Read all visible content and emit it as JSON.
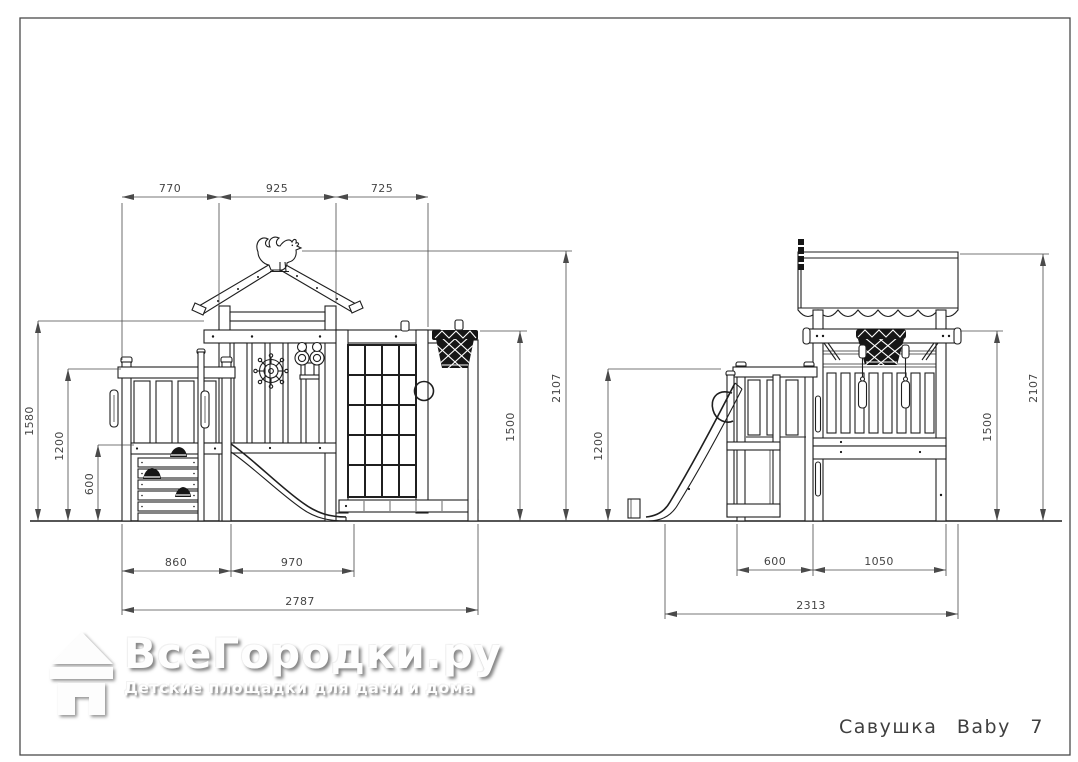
{
  "page": {
    "background": "#ffffff",
    "frame_color": "#4a4a4a",
    "line_color": "#1f1f1f"
  },
  "logo": {
    "brand": "ВсеГородки.ру",
    "tagline": "Детские площадки для дачи и дома",
    "icon": "house-icon"
  },
  "drawing_title": "Савушка Baby 7",
  "views": {
    "front": {
      "label": "front-elevation",
      "dims": {
        "top": [
          "770",
          "925",
          "725"
        ],
        "left": [
          "1580",
          "1200",
          "600"
        ],
        "right": [
          "1500",
          "2107"
        ],
        "bottom_row1": [
          "860",
          "970"
        ],
        "bottom_total": "2787"
      }
    },
    "side": {
      "label": "side-elevation",
      "dims": {
        "left": [
          "1200"
        ],
        "right": [
          "1500",
          "2107"
        ],
        "bottom_row1": [
          "600",
          "1050"
        ],
        "bottom_total": "2313"
      }
    }
  },
  "elements": [
    "gable-roof",
    "rooster-weathervane",
    "ship-wheel",
    "binoculars",
    "basketball-hoop",
    "climbing-lattice",
    "porthole-ring",
    "slide",
    "climbing-stairs-with-holds",
    "grab-handles",
    "scalloped-canopy-roof",
    "swing-straps",
    "access-ladder"
  ]
}
